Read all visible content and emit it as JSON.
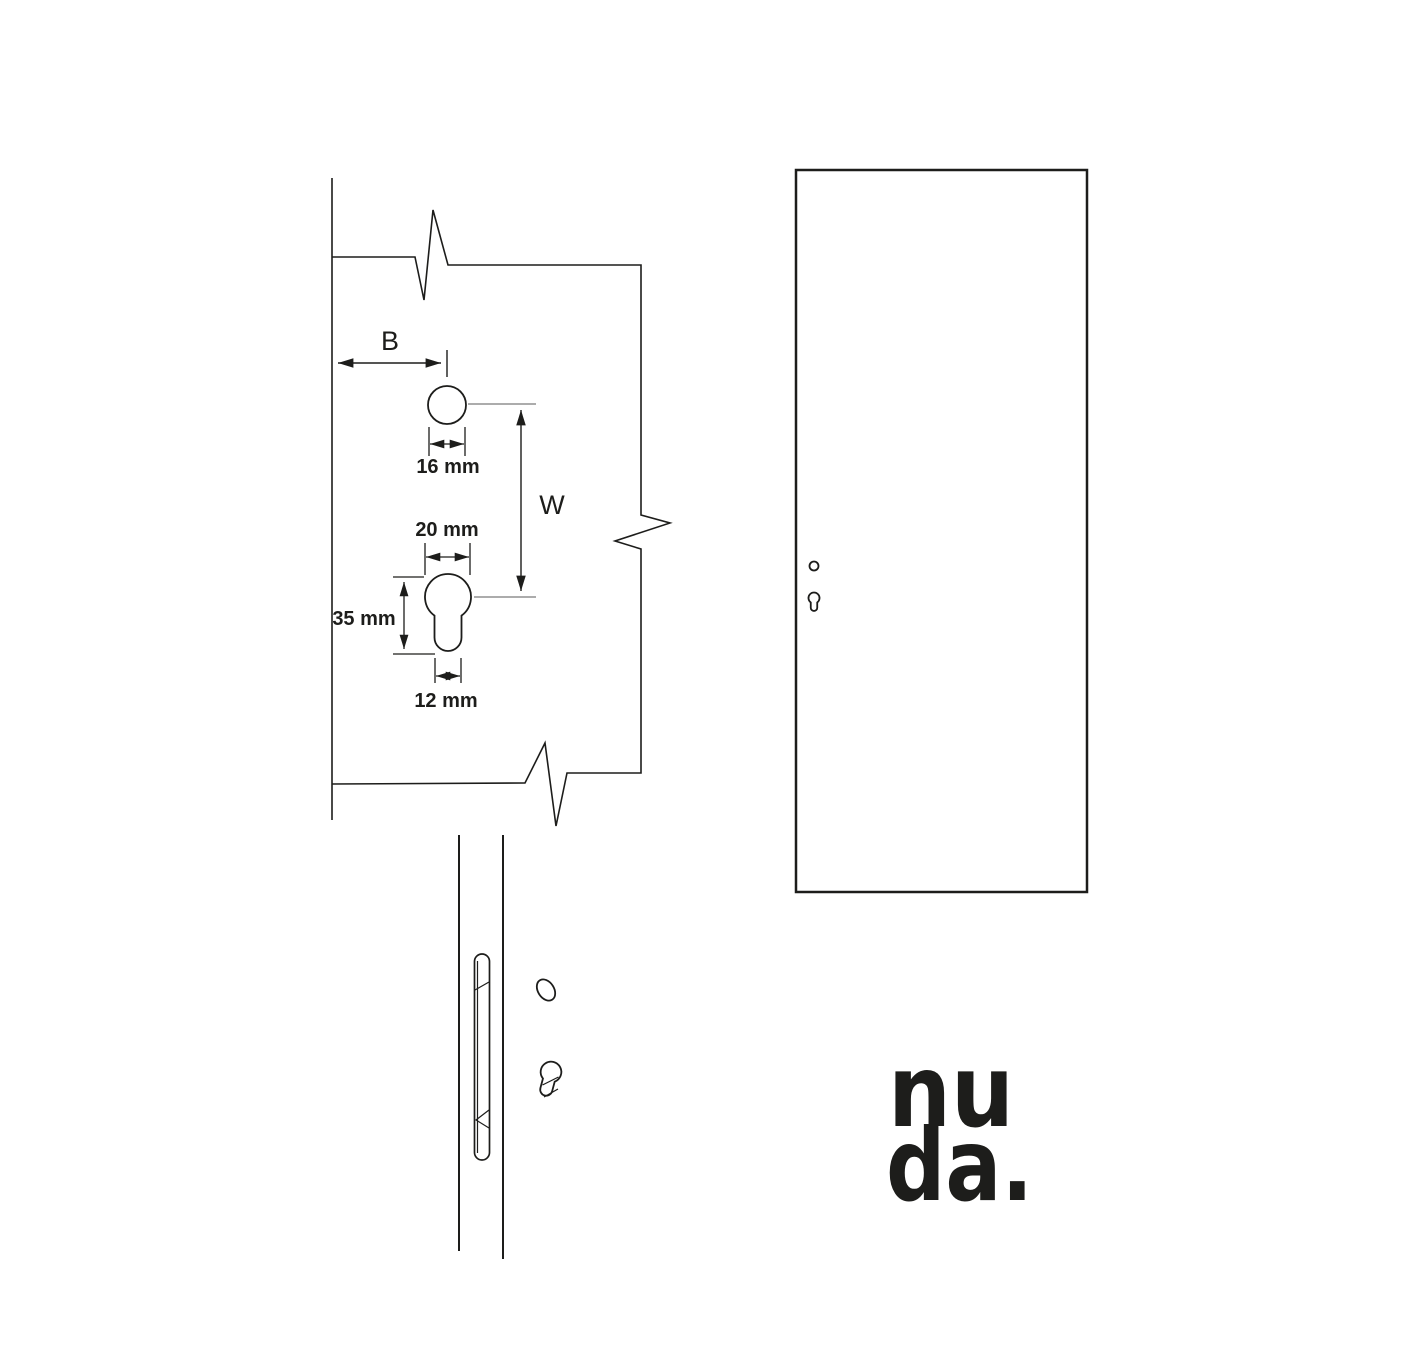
{
  "page": {
    "background": "#ffffff"
  },
  "detail_view": {
    "dim_b": "B",
    "dim_w": "W",
    "dim_handle_hole": "16 mm",
    "dim_cylinder_width": "20 mm",
    "dim_cylinder_height": "35 mm",
    "dim_cylinder_stem": "12 mm"
  },
  "logo": {
    "line1": "nu",
    "line2": "da."
  },
  "colors": {
    "line": "#1d1d1b",
    "ref_line": "#7a7a7a",
    "text": "#1d1d1b"
  }
}
